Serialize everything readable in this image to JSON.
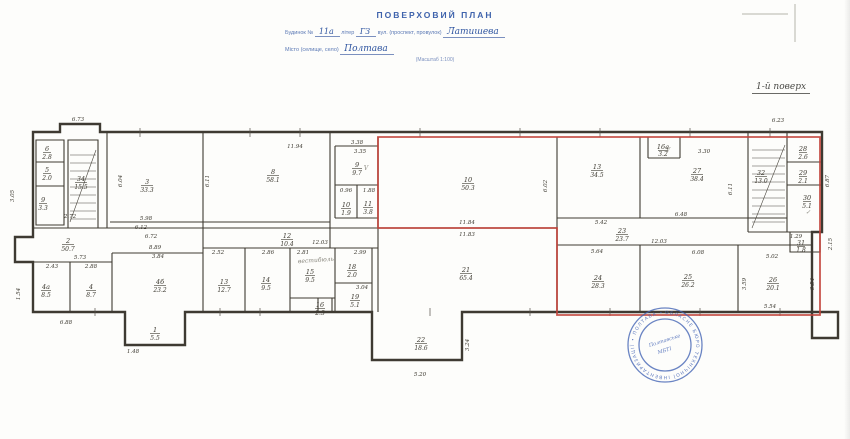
{
  "header": {
    "title": "ПОВЕРХОВИЙ ПЛАН",
    "line1_pre": "Будинок №",
    "line1_no": "11а",
    "line1_liter_label": "літер",
    "line1_liter": "ГЗ",
    "line1_street_label": "вул. (проспект, провулок)",
    "line1_street": "Латишева",
    "line2_label": "Місто (селище, село)",
    "line2_value": "Полтава",
    "scale": "(Масштаб 1:100)",
    "floor_note": "1-й поверх"
  },
  "colors": {
    "ink_blue": "#3f63ac",
    "outline_red": "#c2423a",
    "stamp_blue": "#4565b5",
    "wall": "#3e3a32"
  },
  "rooms": [
    {
      "num": "1",
      "area": "5.5"
    },
    {
      "num": "2",
      "area": "50.7"
    },
    {
      "num": "3",
      "area": "33.3"
    },
    {
      "num": "4а",
      "area": "8.5"
    },
    {
      "num": "4",
      "area": "8.7"
    },
    {
      "num": "4б",
      "area": "23.2"
    },
    {
      "num": "6",
      "area": "2.8"
    },
    {
      "num": "5",
      "area": "2.0"
    },
    {
      "num": "9",
      "area": "3.3"
    },
    {
      "num": "34",
      "area": "15.5"
    },
    {
      "num": "8",
      "area": "58.1"
    },
    {
      "num": "9",
      "area": "9.7"
    },
    {
      "num": "10",
      "area": "1.9"
    },
    {
      "num": "11",
      "area": "3.8"
    },
    {
      "num": "12",
      "area": "10.4"
    },
    {
      "num": "13",
      "area": "12.7"
    },
    {
      "num": "14",
      "area": "9.5"
    },
    {
      "num": "15",
      "area": "9.5"
    },
    {
      "num": "16",
      "area": "2.3"
    },
    {
      "num": "18",
      "area": "2.0"
    },
    {
      "num": "19",
      "area": "5.1"
    },
    {
      "num": "10",
      "area": "50.3"
    },
    {
      "num": "21",
      "area": "65.4"
    },
    {
      "num": "22",
      "area": "18.6"
    },
    {
      "num": "23",
      "area": "23.7"
    },
    {
      "num": "13",
      "area": "34.5"
    },
    {
      "num": "27",
      "area": "38.4"
    },
    {
      "num": "24",
      "area": "28.3"
    },
    {
      "num": "25",
      "area": "26.2"
    },
    {
      "num": "26",
      "area": "20.1"
    },
    {
      "num": "32",
      "area": "13.0"
    },
    {
      "num": "28",
      "area": "2.6"
    },
    {
      "num": "29",
      "area": "2.1"
    },
    {
      "num": "30",
      "area": "5.1"
    },
    {
      "num": "31",
      "area": "1.8"
    },
    {
      "num": "16а",
      "area": "3.2"
    }
  ],
  "dims": [
    "6.73",
    "11.94",
    "3.38",
    "3.35",
    "11.84",
    "11.83",
    "3.30",
    "6.23",
    "5.42",
    "6.48",
    "12.03",
    "5.64",
    "6.08",
    "5.02",
    "5.54",
    "12.03",
    "2.52",
    "2.86",
    "2.81",
    "2.99",
    "3.04",
    "2.72",
    "5.98",
    "6.12",
    "6.72",
    "8.89",
    "3.84",
    "5.73",
    "2.43",
    "2.88",
    "6.88",
    "5.20",
    "1.48",
    "0.96",
    "1.88",
    "1.29",
    "3.05",
    "6.04",
    "6.11",
    "6.02",
    "6.11",
    "6.87",
    "3.59",
    "3.54",
    "1.54",
    "3.24",
    "2.15"
  ],
  "pencil": [
    {
      "t": "вестибюль"
    },
    {
      "t": "V"
    },
    {
      "t": "V"
    },
    {
      "t": "✓"
    }
  ],
  "stamp": {
    "ring_text": "ОБЛАСНЕ БЮРО ТЕХНІЧНОЇ ІНВЕНТАРИЗАЦІЇ • ПОЛТАВА •",
    "center_line1": "Полтавське",
    "center_line2": "МБТІ"
  }
}
